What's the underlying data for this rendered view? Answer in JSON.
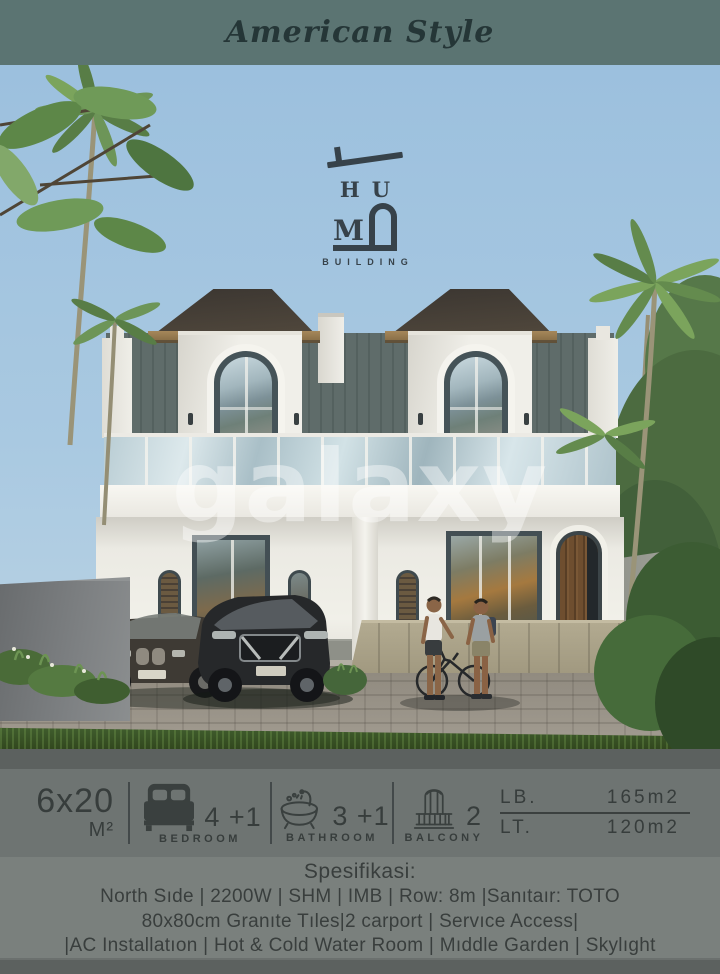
{
  "header": {
    "title": "American Style"
  },
  "logo": {
    "line1": "HU",
    "line2": "M",
    "subtitle": "BUILDING"
  },
  "watermark": {
    "text": "galaxy"
  },
  "specs": {
    "size": {
      "value": "6x20",
      "unit": "M²"
    },
    "items": [
      {
        "icon": "bed-icon",
        "count": "4 +1",
        "label": "BEDROOM"
      },
      {
        "icon": "bathtub-icon",
        "count": "3 +1",
        "label": "BATHROOM"
      },
      {
        "icon": "balcony-icon",
        "count": "2",
        "label": "BALCONY"
      }
    ],
    "area": {
      "lb_label": "LB.",
      "lb_value": "165m2",
      "lt_label": "LT.",
      "lt_value": "120m2"
    }
  },
  "details": {
    "title": "Spesifikasi:",
    "lines": [
      "North Sıde | 2200W | SHM | IMB | Row: 8m |Sanıtaır: TOTO",
      "80x80cm Granıte Tıles|2 carport | Servıce Access|",
      "|AC Installatıon | Hot & Cold Water Room | Mıddle Garden | Skylıght"
    ]
  },
  "colors": {
    "header_bg": "#5b7472",
    "sky": "#9cc0de",
    "bar_bg": "#6e7472",
    "strip_bg": "#5c615f",
    "text_dark": "#373d3c",
    "wall_white": "#f0efe9",
    "frame_dark": "#455358"
  }
}
